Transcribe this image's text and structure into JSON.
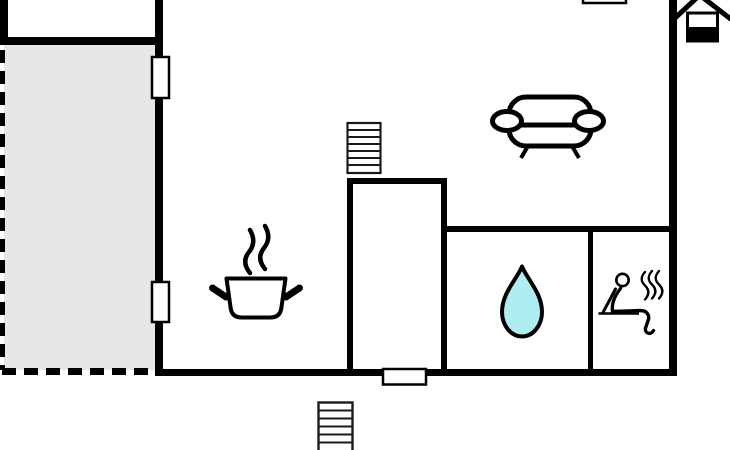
{
  "floorplan": {
    "canvas": {
      "width": 730,
      "height": 450
    },
    "colors": {
      "background": "#ffffff",
      "wall": "#000000",
      "terrace_fill": "#e7e7ea",
      "terrace_dash": "#000000",
      "stairs_outline": "#1a1a1a",
      "steam_gray": "#8a8a8a",
      "water_drop_fill": "#aeedf0",
      "icon_outline": "#000000"
    },
    "features": {
      "window_count": 3,
      "door_count": 1,
      "staircase_count": 2
    },
    "areas": [
      {
        "name": "terrace",
        "style": "grey fill with dashed outline"
      },
      {
        "name": "upper-left-room",
        "style": "cut off at top edge"
      },
      {
        "name": "main-room",
        "style": "open living/kitchen space"
      },
      {
        "name": "stairwell",
        "style": "inner walled rectangle"
      },
      {
        "name": "bathroom",
        "style": "marked with water drop"
      },
      {
        "name": "sauna-room",
        "style": "marked with sauna person"
      }
    ],
    "icons": [
      {
        "name": "sofa-icon",
        "depicts": "sofa seen from above (lounge)"
      },
      {
        "name": "cooking-pot-icon",
        "depicts": "steaming cooking pot (kitchen)"
      },
      {
        "name": "water-drop-icon",
        "depicts": "water drop (bath/shower)"
      },
      {
        "name": "sauna-icon",
        "depicts": "seated person with heat waves (sauna)"
      },
      {
        "name": "birdhouse-icon",
        "depicts": "small house/birdhouse outside right wall"
      },
      {
        "name": "stairs-icon-upper",
        "depicts": "staircase (hatched rectangle)"
      },
      {
        "name": "stairs-icon-lower",
        "depicts": "staircase (hatched rectangle, cut off at bottom)"
      }
    ]
  }
}
